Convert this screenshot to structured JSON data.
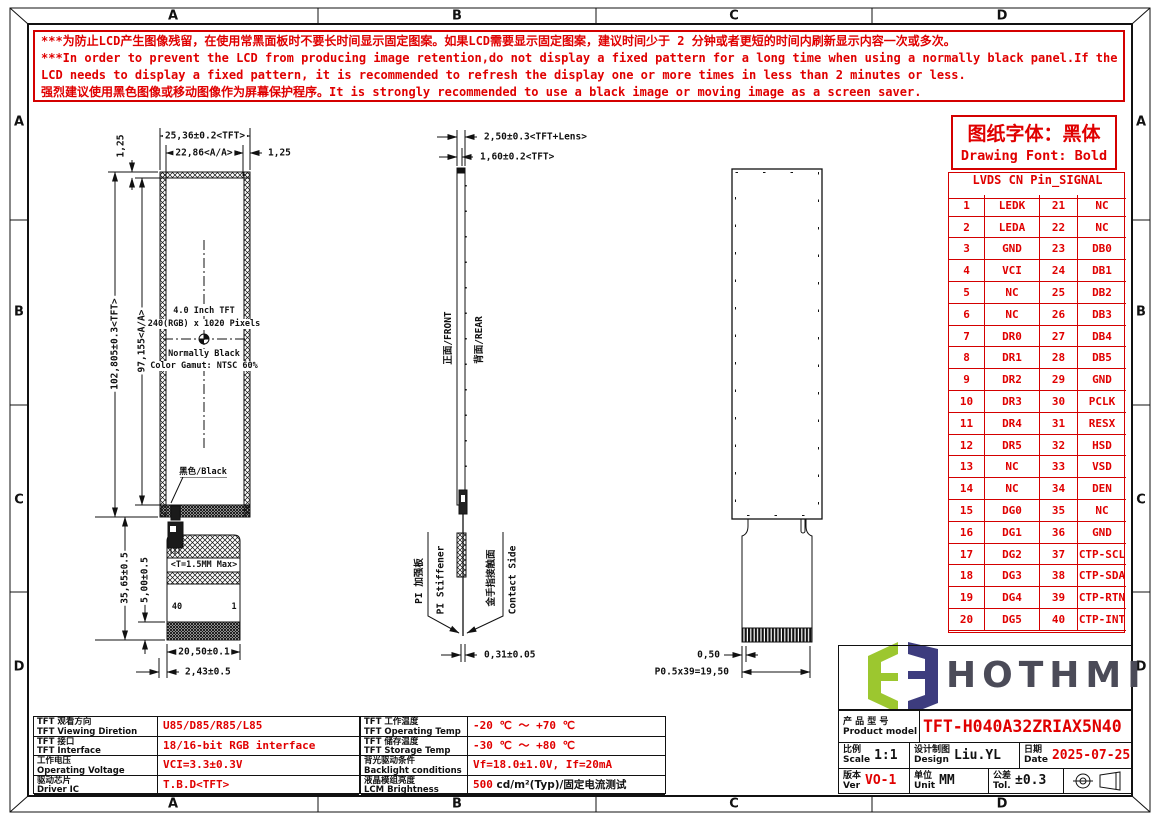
{
  "grid": {
    "cols": [
      "A",
      "B",
      "C",
      "D"
    ],
    "rows": [
      "A",
      "B",
      "C",
      "D"
    ]
  },
  "warning": {
    "lines": [
      "***为防止LCD产生图像残留，在使用常黑面板时不要长时间显示固定图案。如果LCD需要显示固定图案，建议时间少于 2 分钟或者更短的时间内刷新显示内容一次或多次。",
      "***In order to prevent the LCD from producing image retention,do not display a fixed pattern for a long time when using a normally black panel.If the",
      " LCD needs to display a fixed pattern, it is recommended to refresh the display one or more times in less than 2 minutes or less.",
      "强烈建议使用黑色图像或移动图像作为屏幕保护程序。It is strongly recommended to use a black image or moving image as a screen saver."
    ]
  },
  "font_note": {
    "cn": "图纸字体：黑体",
    "en": "Drawing Font: Bold"
  },
  "pin_table": {
    "title": "LVDS CN Pin_SIGNAL",
    "rows": [
      [
        "1",
        "LEDK",
        "21",
        "NC"
      ],
      [
        "2",
        "LEDA",
        "22",
        "NC"
      ],
      [
        "3",
        "GND",
        "23",
        "DB0"
      ],
      [
        "4",
        "VCI",
        "24",
        "DB1"
      ],
      [
        "5",
        "NC",
        "25",
        "DB2"
      ],
      [
        "6",
        "NC",
        "26",
        "DB3"
      ],
      [
        "7",
        "DR0",
        "27",
        "DB4"
      ],
      [
        "8",
        "DR1",
        "28",
        "DB5"
      ],
      [
        "9",
        "DR2",
        "29",
        "GND"
      ],
      [
        "10",
        "DR3",
        "30",
        "PCLK"
      ],
      [
        "11",
        "DR4",
        "31",
        "RESX"
      ],
      [
        "12",
        "DR5",
        "32",
        "HSD"
      ],
      [
        "13",
        "NC",
        "33",
        "VSD"
      ],
      [
        "14",
        "NC",
        "34",
        "DEN"
      ],
      [
        "15",
        "DG0",
        "35",
        "NC"
      ],
      [
        "16",
        "DG1",
        "36",
        "GND"
      ],
      [
        "17",
        "DG2",
        "37",
        "CTP-SCL"
      ],
      [
        "18",
        "DG3",
        "38",
        "CTP-SDA"
      ],
      [
        "19",
        "DG4",
        "39",
        "CTP-RTN"
      ],
      [
        "20",
        "DG5",
        "40",
        "CTP-INT"
      ]
    ]
  },
  "front_view": {
    "dim_width_tft": "25,36±0.2<TFT>",
    "dim_width_aa": "22,86<A/A>",
    "dim_margin_right": "1,25",
    "dim_margin_top": "1,25",
    "dim_height_tft": "102,805±0.3<TFT>",
    "dim_height_aa": "97,155<A/A>",
    "dim_fpc_len": "35,65±0.5",
    "dim_fpc_5": "5,00±0.5",
    "dim_fpc_w": "20,50±0.1",
    "dim_fpc_off": "2,43±0.5",
    "center_text": [
      "4.0 Inch TFT",
      "240(RGB) x 1020 Pixels",
      "Normally Black",
      "Color Gamut: NTSC 60%"
    ],
    "black_label": "黑色/Black",
    "t_note": "<T=1.5MM Max>",
    "pin_left": "40",
    "pin_right": "1"
  },
  "side_view": {
    "dim_thick_lens": "2,50±0.3<TFT+Lens>",
    "dim_thick_tft": "1,60±0.2<TFT>",
    "front_label": "正面/FRONT",
    "rear_label": "背面/REAR",
    "pi_cn": "PI 加强板",
    "pi_en": "PI Stiffener",
    "contact_cn": "金手指接触面",
    "contact_en": "Contact Side",
    "dim_fpc_thick": "0,31±0.05"
  },
  "rear_view": {
    "dim_pitch_unit": "0,50",
    "dim_pitch_total": "P0.5x39=19,50"
  },
  "logo": {
    "text": "HOTHMI",
    "green": "#9cc72f",
    "navy": "#3d3c7e"
  },
  "title_block": {
    "model_cn": "产 品 型 号",
    "model_en": "Product model",
    "model_value": "TFT-H040A32ZRIAX5N40",
    "scale_cn": "比例",
    "scale_en": "Scale",
    "scale_value": "1:1",
    "design_cn": "设计制图",
    "design_en": "Design",
    "design_value": "Liu.YL",
    "date_cn": "日期",
    "date_en": "Date",
    "date_value": "2025-07-25",
    "ver_cn": "版本",
    "ver_en": "Ver",
    "ver_value": "VO-1",
    "unit_cn": "单位",
    "unit_en": "Unit",
    "unit_value": "MM",
    "tol_cn": "公差",
    "tol_en": "Tol.",
    "tol_value": "±0.3"
  },
  "spec_left": [
    {
      "cn": "TFT 观看方向",
      "en": "TFT Viewing Diretion",
      "red": "U85/D85/R85/L85",
      "black": ""
    },
    {
      "cn": "TFT 接口",
      "en": "TFT Interface",
      "red": "18/16-bit RGB interface",
      "black": ""
    },
    {
      "cn": "工作电压",
      "en": "Operating Voltage",
      "red": "VCI=3.3±0.3V",
      "black": ""
    },
    {
      "cn": "驱动芯片",
      "en": "Driver IC",
      "red": "T.B.D<TFT>",
      "black": ""
    }
  ],
  "spec_mid": [
    {
      "cn": "TFT 工作温度",
      "en": "TFT Operating Temp",
      "red": "-20 ℃ ～ +70 ℃",
      "black": ""
    },
    {
      "cn": "TFT 储存温度",
      "en": "TFT Storage Temp",
      "red": "-30 ℃ ～ +80 ℃",
      "black": ""
    },
    {
      "cn": "背光驱动条件",
      "en": "Backlight conditions",
      "red": "Vf=18.0±1.0V, If=20mA",
      "black": ""
    },
    {
      "cn": "液晶模组亮度",
      "en": "LCM Brightness",
      "red": "500",
      "black": " cd/m²(Typ)/固定电流测试"
    }
  ]
}
